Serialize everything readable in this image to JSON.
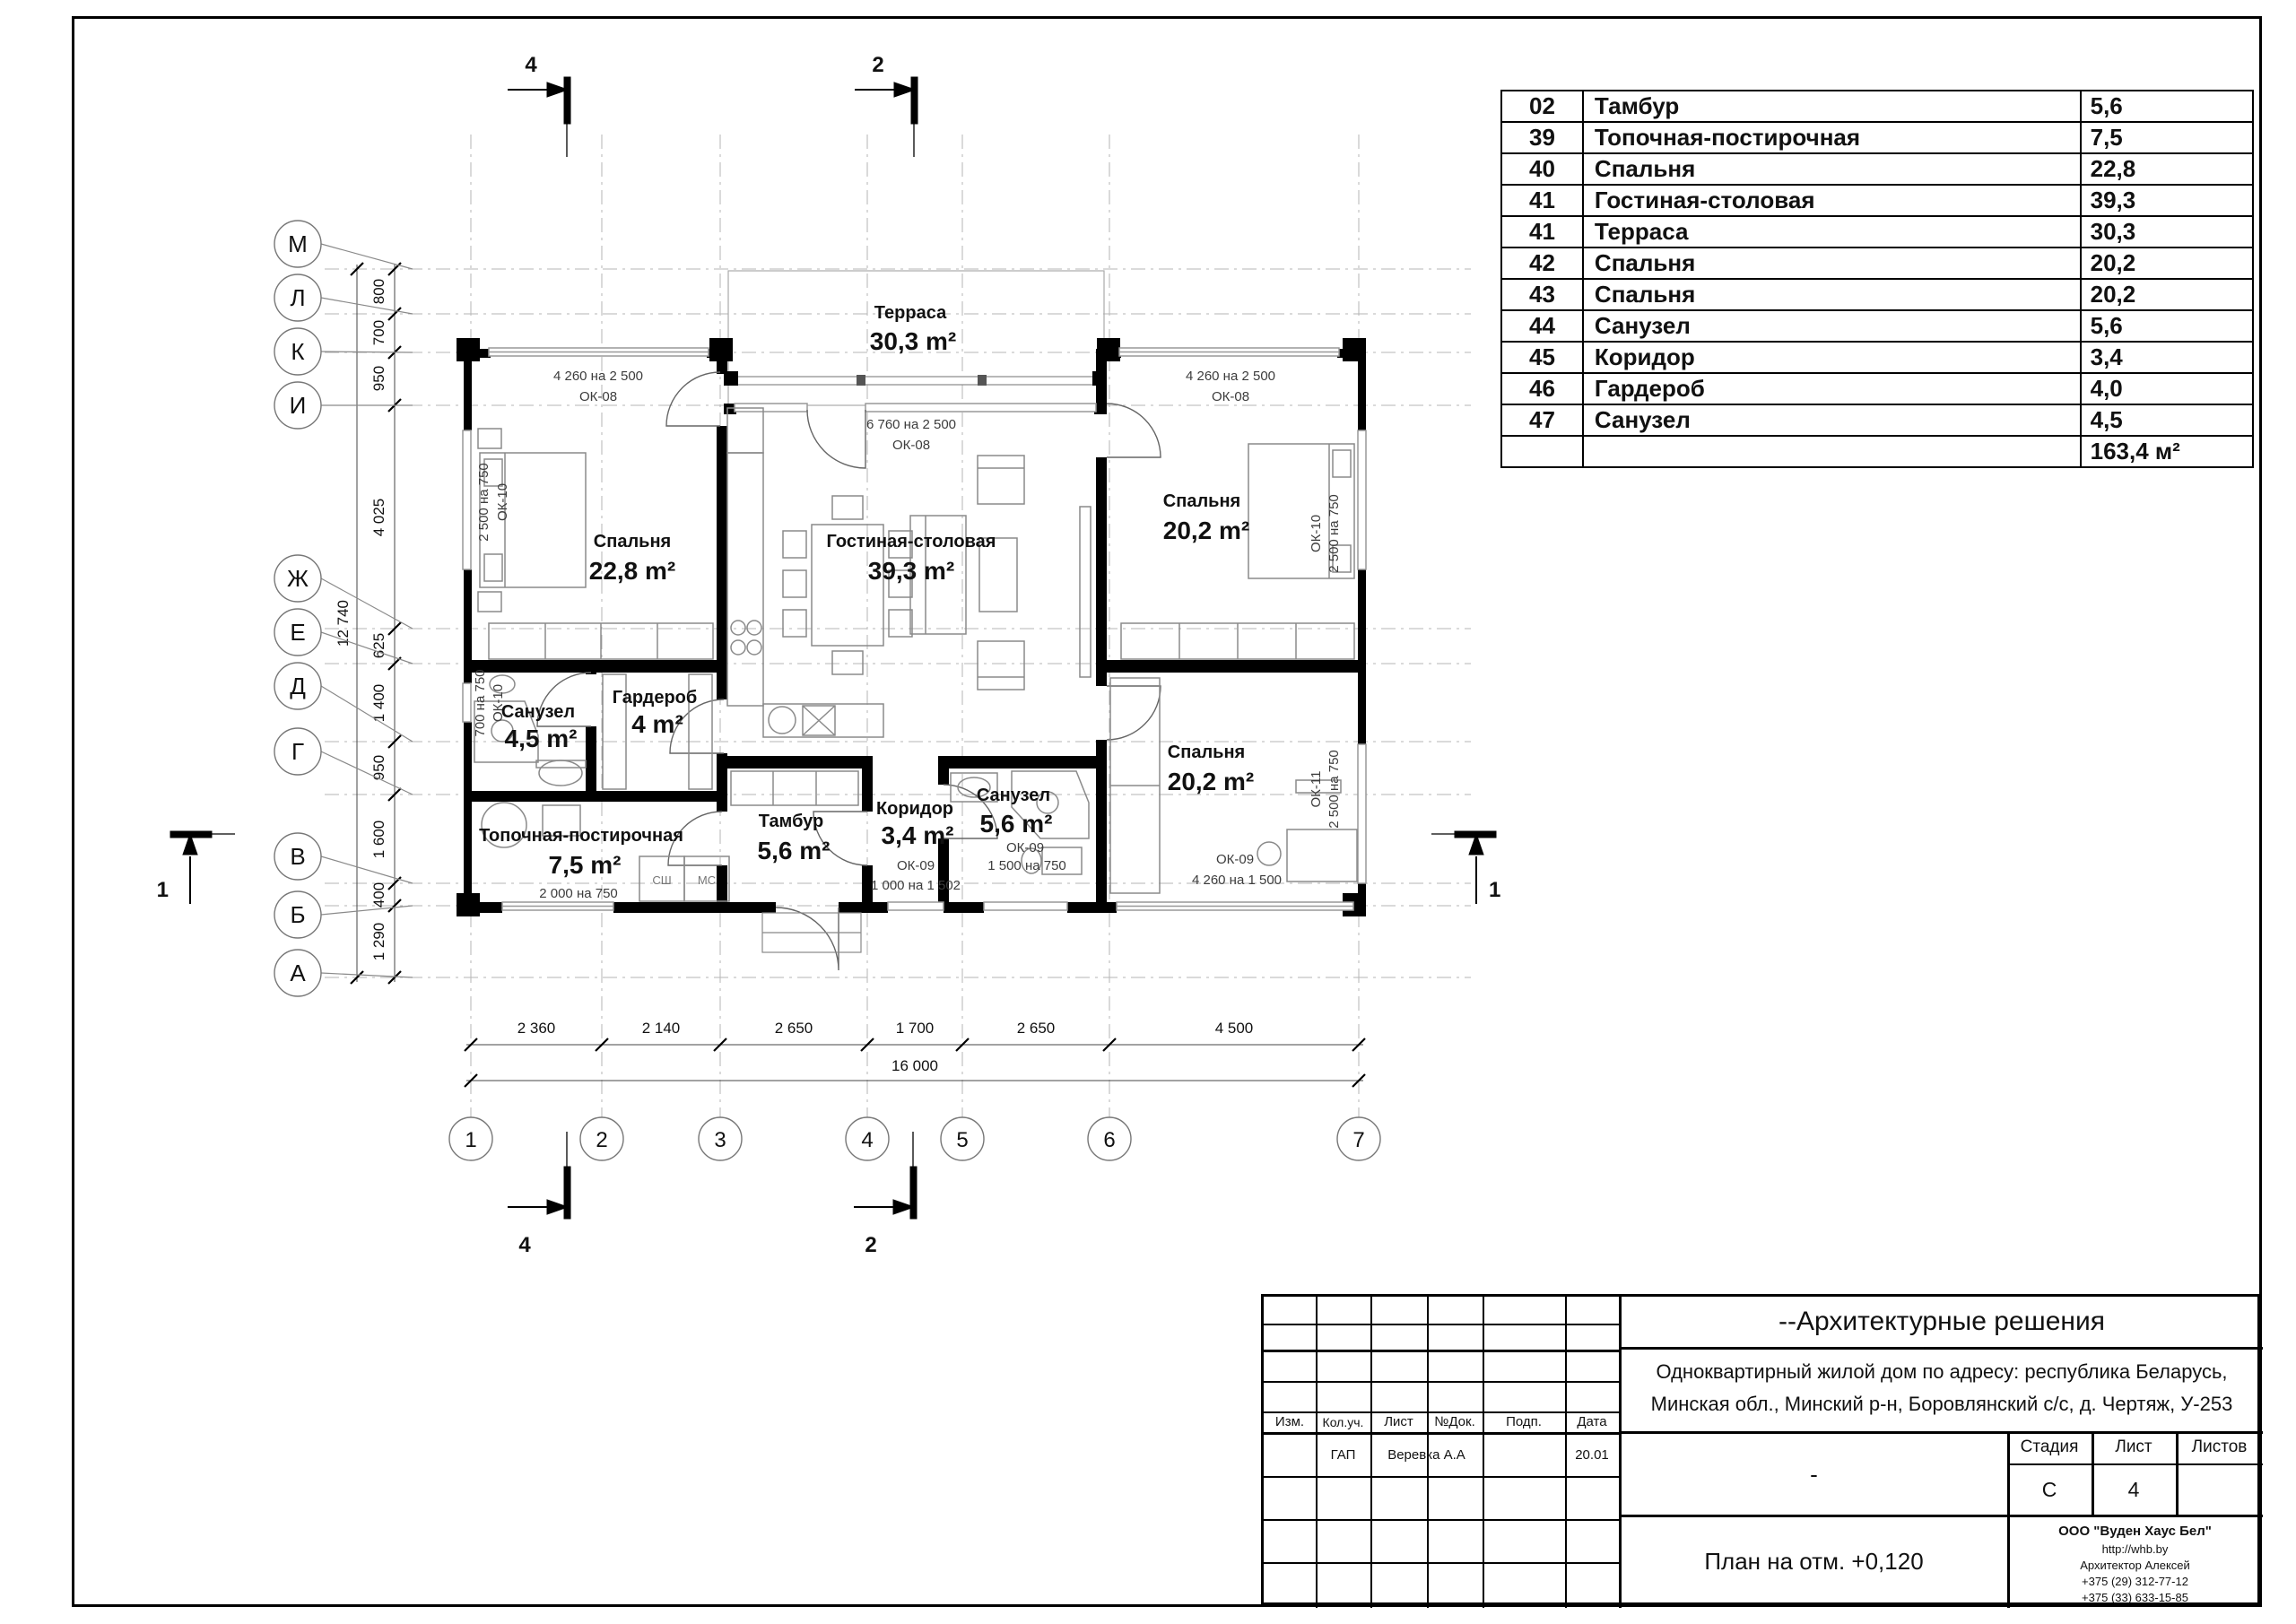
{
  "colors": {
    "paper": "#ffffff",
    "ink": "#111111",
    "grid": "#b5b5b5",
    "furniture": "#8a8a8a",
    "window_line": "#999999"
  },
  "room_table": {
    "rows": [
      {
        "num": "02",
        "name": "Тамбур",
        "area": "5,6"
      },
      {
        "num": "39",
        "name": "Топочная-постирочная",
        "area": "7,5"
      },
      {
        "num": "40",
        "name": "Спальня",
        "area": "22,8"
      },
      {
        "num": "41",
        "name": "Гостиная-столовая",
        "area": "39,3"
      },
      {
        "num": "41",
        "name": "Терраса",
        "area": "30,3"
      },
      {
        "num": "42",
        "name": "Спальня",
        "area": "20,2"
      },
      {
        "num": "43",
        "name": "Спальня",
        "area": "20,2"
      },
      {
        "num": "44",
        "name": "Санузел",
        "area": "5,6"
      },
      {
        "num": "45",
        "name": "Коридор",
        "area": "3,4"
      },
      {
        "num": "46",
        "name": "Гардероб",
        "area": "4,0"
      },
      {
        "num": "47",
        "name": "Санузел",
        "area": "4,5"
      }
    ],
    "total_area": "163,4 м²"
  },
  "plan": {
    "rooms": {
      "terrace": {
        "name": "Терраса",
        "area": "30,3 m²"
      },
      "bedroom1": {
        "name": "Спальня",
        "area": "22,8 m²"
      },
      "living": {
        "name": "Гостиная-столовая",
        "area": "39,3 m²"
      },
      "bedroom2": {
        "name": "Спальня",
        "area": "20,2 m²"
      },
      "bedroom3": {
        "name": "Спальня",
        "area": "20,2 m²"
      },
      "bath1": {
        "name": "Санузел",
        "area": "4,5 m²"
      },
      "wardrobe": {
        "name": "Гардероб",
        "area": "4 m²"
      },
      "boiler": {
        "name": "Топочная-постирочная",
        "area": "7,5 m²"
      },
      "tambour": {
        "name": "Тамбур",
        "area": "5,6 m²"
      },
      "corridor": {
        "name": "Коридор",
        "area": "3,4 m²"
      },
      "bath2": {
        "name": "Санузел",
        "area": "5,6 m²"
      }
    },
    "windows": {
      "w1": {
        "line1": "4 260 на 2 500",
        "line2": "ОК-08"
      },
      "w2": {
        "line1": "6 760 на 2 500",
        "line2": "ОК-08"
      },
      "w3": {
        "line1": "4 260 на 2 500",
        "line2": "ОК-08"
      },
      "w4": {
        "line1": "2 500 на 750",
        "line2": "ОК-10"
      },
      "w5": {
        "line1": "700 на 750",
        "line2": "ОК-10"
      },
      "w6": {
        "line1": "2 000 на 750",
        "line2": ""
      },
      "w7": {
        "line1": "1 000 на 1 502",
        "line2": "ОК-09"
      },
      "w8": {
        "line1": "1 500 на 750",
        "line2": "ОК-09"
      },
      "w9": {
        "line1": "4 260 на 1 500",
        "line2": "ОК-09"
      },
      "w10": {
        "line1": "2 500 на 750",
        "line2": "ОК-10"
      },
      "w11": {
        "line1": "2 500 на 750",
        "line2": "ОК-11"
      }
    },
    "appliances": [
      "СШ",
      "МС"
    ]
  },
  "axes": {
    "letters": [
      "М",
      "Л",
      "К",
      "И",
      "Ж",
      "Е",
      "Д",
      "Г",
      "В",
      "Б",
      "А"
    ],
    "numbers": [
      "1",
      "2",
      "3",
      "4",
      "5",
      "6",
      "7"
    ],
    "left_dims": [
      "800",
      "700",
      "950",
      "4 025",
      "625",
      "1 400",
      "950",
      "1 600",
      "400",
      "1 290"
    ],
    "left_total": "12 740",
    "bottom_dims": [
      "2 360",
      "2 140",
      "2 650",
      "1 700",
      "2 650",
      "4 500"
    ],
    "bottom_total": "16 000"
  },
  "markers": {
    "top_left": "4",
    "top_right": "2",
    "bottom_left": "4",
    "bottom_right": "2",
    "left": "1",
    "right": "1"
  },
  "title_block": {
    "doc_type": "--Архитектурные решения",
    "address_line1": "Одноквартирный  жилой дом по адресу: республика Беларусь,",
    "address_line2": "Минская обл., Минский р-н, Боровлянский с/с, д. Чертяж, У-253",
    "cols": [
      "Изм.",
      "Кол.уч.",
      "Лист",
      "№Док.",
      "Подп.",
      "Дата"
    ],
    "row_role": "ГАП",
    "row_name": "Веревка А.А",
    "row_date": "20.01",
    "stage_label": "Стадия",
    "sheet_label": "Лист",
    "sheets_label": "Листов",
    "stage_value": "С",
    "sheet_value": "4",
    "middle_dash": "-",
    "drawing_title": "План на отм. +0,120",
    "company": "ООО \"Вуден Хаус Бел\"",
    "website": "http://whb.by",
    "architect": "Архитектор Алексей",
    "phone1": "+375 (29) 312-77-12",
    "phone2": "+375 (33) 633-15-85"
  }
}
